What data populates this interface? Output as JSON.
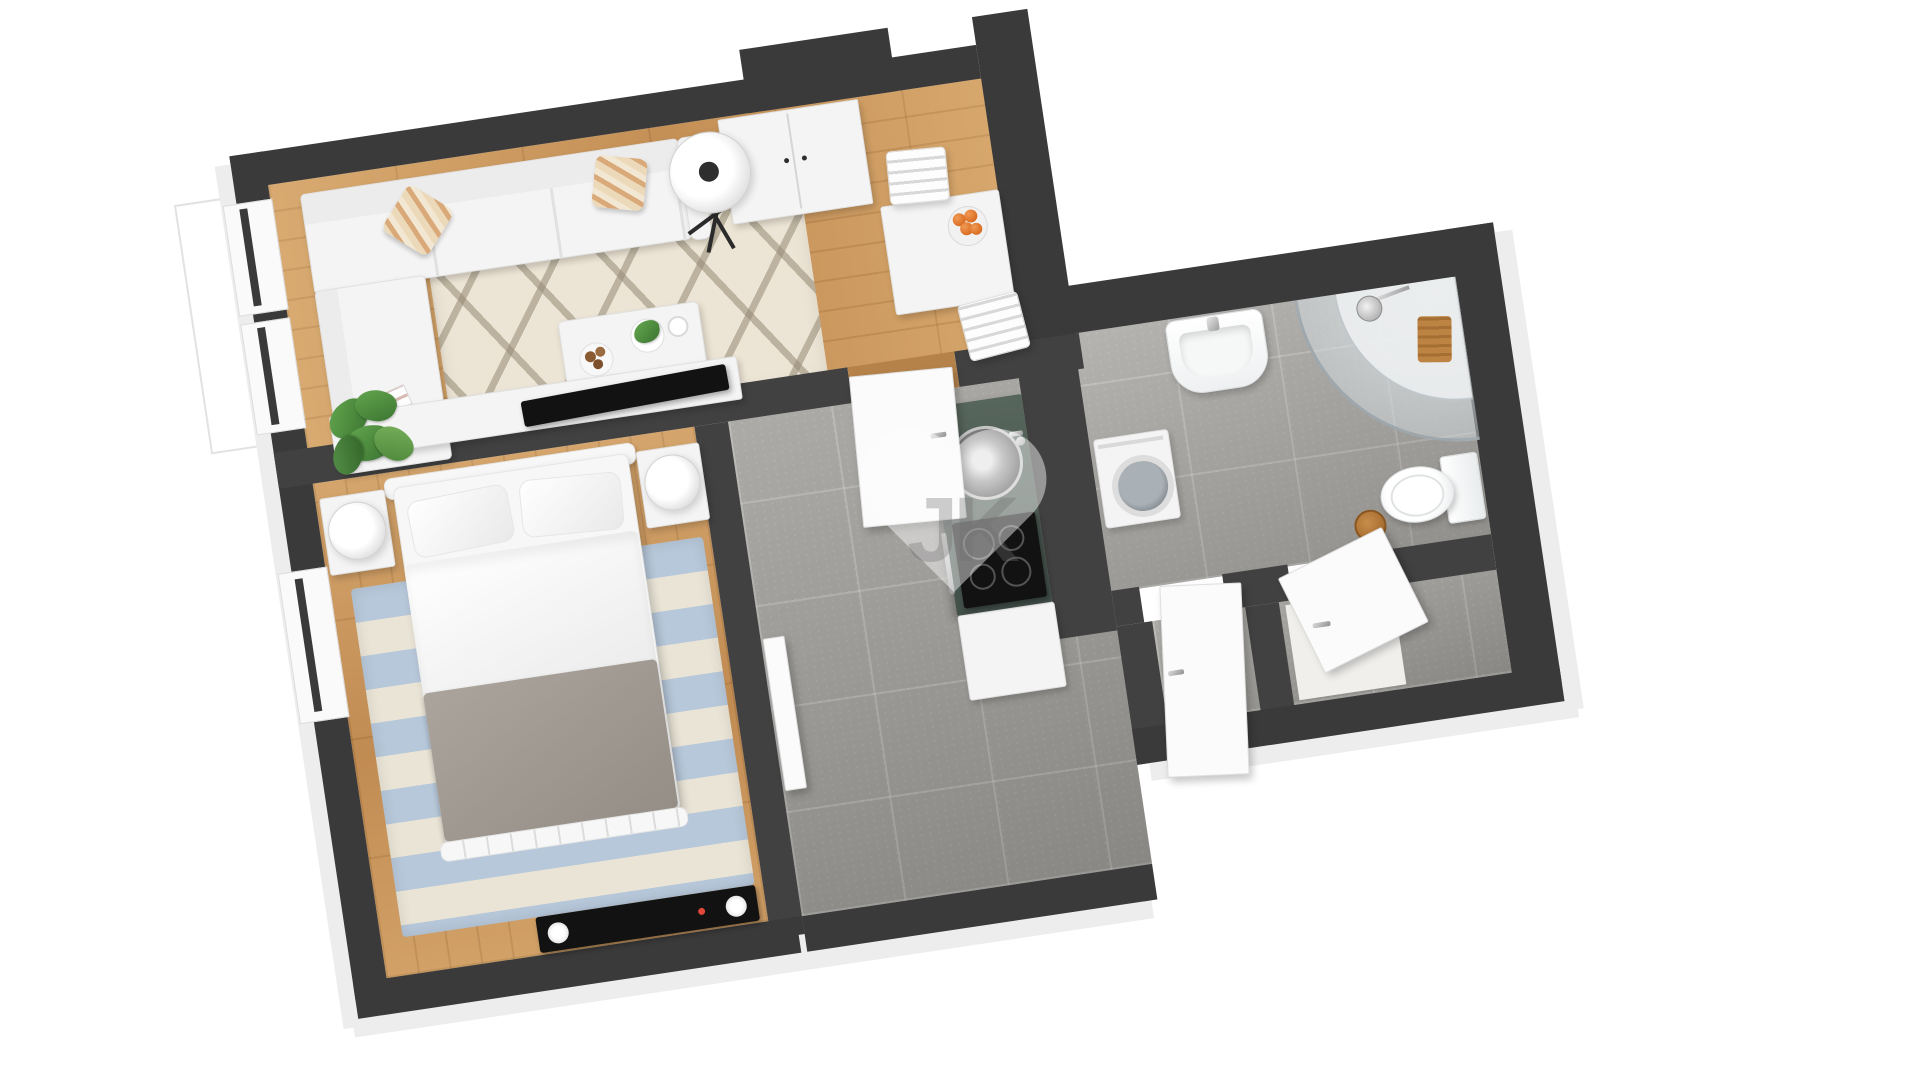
{
  "page": {
    "kind": "3d-floor-plan-render",
    "background": "#ffffff"
  },
  "watermark": {
    "text": "JK",
    "shape": "heart",
    "color": "#ffffff"
  },
  "palette": {
    "wall_top": "#3a3a3a",
    "wall_outer_face": "#ededed",
    "wood_floor": "#cd9a5f",
    "tile_floor": "#a3a19d",
    "rug_cream": "#ece4d4",
    "rug_lattice": "#94885f",
    "rug_stripe_blue": "#b7c8da",
    "rug_stripe_cream": "#e9e4d6",
    "kitchen_counter": "#4c5a52",
    "cooktop": "#121212",
    "oranges": "#d96a1f",
    "plant_green": "#4d8f3d",
    "throw_gray": "#a09a93",
    "furniture_white": "#f4f4f4"
  },
  "plan": {
    "rotation_deg": -8.5,
    "rooms": [
      {
        "id": "living-room",
        "floor": "wood",
        "furniture": [
          "corner-sofa",
          "striped-pillow",
          "striped-pillow",
          "magazines",
          "tripod-floor-lamp",
          "diamond-rug",
          "coffee-table",
          "potted-plant",
          "coffee-cups",
          "pastry-plate",
          "monstera-plant",
          "tv-lowboard",
          "television",
          "wardrobe",
          "dining-table",
          "fruit-bowl-oranges",
          "dining-chair",
          "dining-chair",
          "window",
          "window"
        ]
      },
      {
        "id": "bedroom",
        "floor": "wood",
        "furniture": [
          "double-bed",
          "headboard",
          "pillow",
          "pillow",
          "duvet",
          "gray-throw",
          "footboard",
          "nightstand",
          "nightstand",
          "table-lamp",
          "table-lamp",
          "striped-rug",
          "media-unit",
          "speaker",
          "speaker",
          "window"
        ]
      },
      {
        "id": "hallway",
        "floor": "tile",
        "furniture": [
          "entry-door",
          "bedroom-door",
          "threshold"
        ]
      },
      {
        "id": "kitchen",
        "floor": "tile",
        "furniture": [
          "counter",
          "round-sink",
          "faucet",
          "cooktop-4-burners",
          "oven-handle",
          "base-cabinet"
        ]
      },
      {
        "id": "bathroom",
        "floor": "tile",
        "furniture": [
          "washing-machine",
          "wall-sink",
          "faucet",
          "corner-shower",
          "shower-head",
          "duckboard",
          "toilet",
          "wood-stool"
        ]
      },
      {
        "id": "storage-rooms",
        "floor": "tile",
        "furniture": [
          "door",
          "door"
        ]
      }
    ]
  }
}
